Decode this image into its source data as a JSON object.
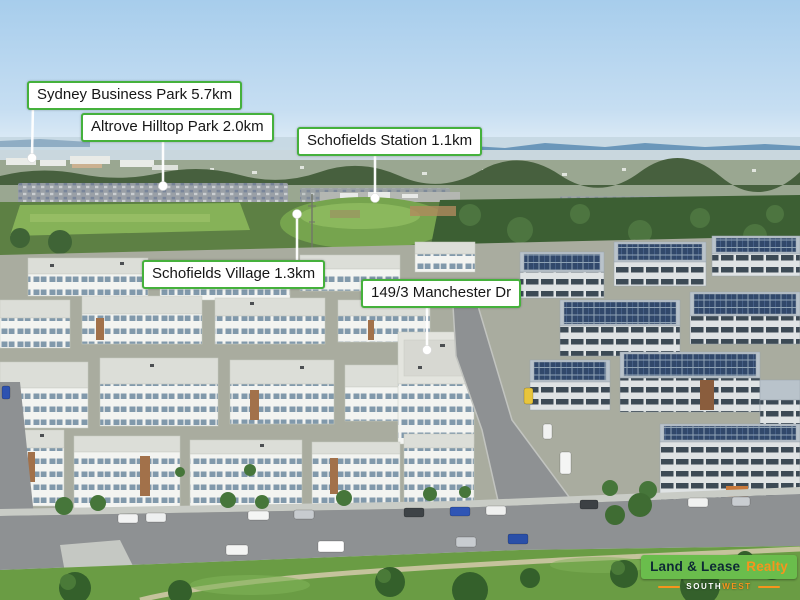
{
  "overlay": {
    "labels": [
      {
        "id": "sydney-business-park",
        "text": "Sydney Business Park 5.7km"
      },
      {
        "id": "altrove-hilltop-park",
        "text": "Altrove Hilltop Park 2.0km"
      },
      {
        "id": "schofields-station",
        "text": "Schofields Station 1.1km"
      },
      {
        "id": "schofields-village",
        "text": "Schofields Village 1.3km"
      },
      {
        "id": "property-address",
        "text": "149/3 Manchester Dr"
      }
    ]
  },
  "logo": {
    "brand_primary": "Land & Lease",
    "brand_secondary": "Realty",
    "region_south": "SOUTH",
    "region_west": "WEST"
  },
  "colors": {
    "label_border_green": "#45b13c",
    "label_background": "#ffffff",
    "label_text": "#161616",
    "marker_white": "#ffffff",
    "logo_banner_green": "#6abd4c",
    "logo_text_dark": "#0e2935",
    "logo_accent_orange": "#f7941d"
  }
}
